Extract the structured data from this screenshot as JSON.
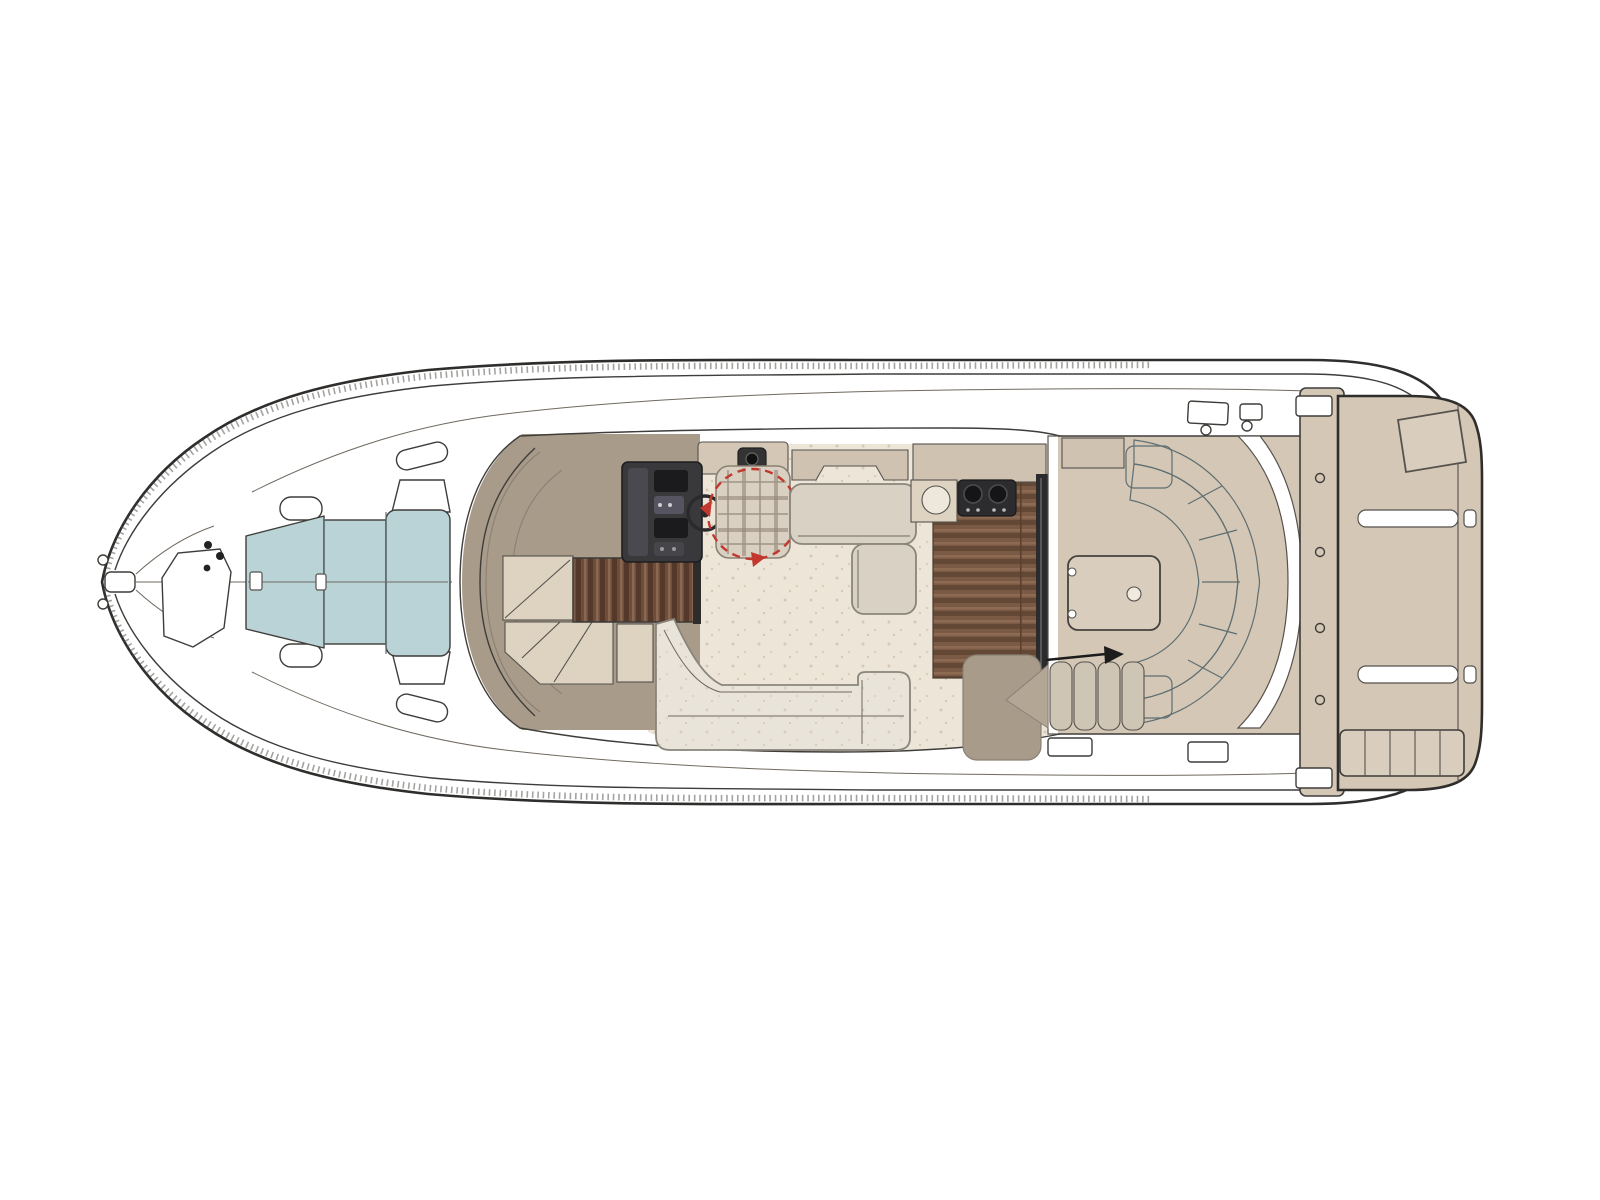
{
  "document": {
    "title": "Motor yacht main deck floor plan (top view)",
    "type": "boat-deck-plan",
    "orientation": "bow-left-stern-right",
    "visible_text": "none"
  },
  "colors": {
    "page_bg": "#ffffff",
    "line": "#3f3d3a",
    "deck_tan": "#d4c7b5",
    "deck_tan_light": "#d9cdbd",
    "counter_tan": "#cfc2b0",
    "cabin_taupe": "#a89b8a",
    "wedge_taupe": "#b3a694",
    "panel_cream": "#ddd3c0",
    "floor_cream": "#ede6d8",
    "step_cream": "#cfc5b4",
    "upholstery_white": "#e9e4da",
    "upholstery_gray": "#d8d1c4",
    "cushion_blue": "#b9d3d6",
    "cushion_blue_dark": "#a8c9cd",
    "helm_dark": "#39383a",
    "helm_panel": "#4a4950",
    "helm_screen": "#1b1b1d",
    "appliance_dark": "#2c2c2e",
    "fridge_dark": "#2b2a2c",
    "accent_red": "#c2372e",
    "arrow_black": "#1c1c1c",
    "sink_white": "#eee8dc"
  },
  "features": {
    "bow": {
      "pulpit": "Bow pulpit with anchor roller",
      "anchor_locker": "Anchor locker hatch",
      "sun_pad": "Bow sun pad with raised backrest"
    },
    "helm": {
      "console": "Helm console with instrument screens",
      "wheel": "Steering wheel",
      "swivel_seat": "Swivel helm seat with rotation arrows",
      "cabinet": "Cabinet aft of helm"
    },
    "salon": {
      "windshield": "Wraparound windshield",
      "companionway": "Teak companionway steps to lower deck",
      "sofa_port": "L-shaped salon sofa (port side)",
      "dinette_starboard": "L-shaped dinette bench (starboard side)",
      "floor": "Salon floor"
    },
    "galley": {
      "counter": "Galley counter",
      "sink": "Round sink",
      "cooktop": "Two-burner cooktop",
      "refrigerator": "Refrigerator / tall unit",
      "floor": "Teak galley floor"
    },
    "cockpit": {
      "deck": "Cockpit deck",
      "engine_hatch": "Engine room hatch with latch",
      "aft_bench": "Curved aft bench seat",
      "entry_steps": "Steps down into cockpit with direction arrow",
      "wedge": "Moulded step wedge"
    },
    "stern": {
      "transom": "Transom bulkhead",
      "walkway": "Transom walk-through",
      "platform": "Swim platform",
      "platform_seat": "Removable platform seat/step",
      "grab_rails": "Recessed grab rails",
      "ladder": "Telescopic swim ladder"
    }
  }
}
